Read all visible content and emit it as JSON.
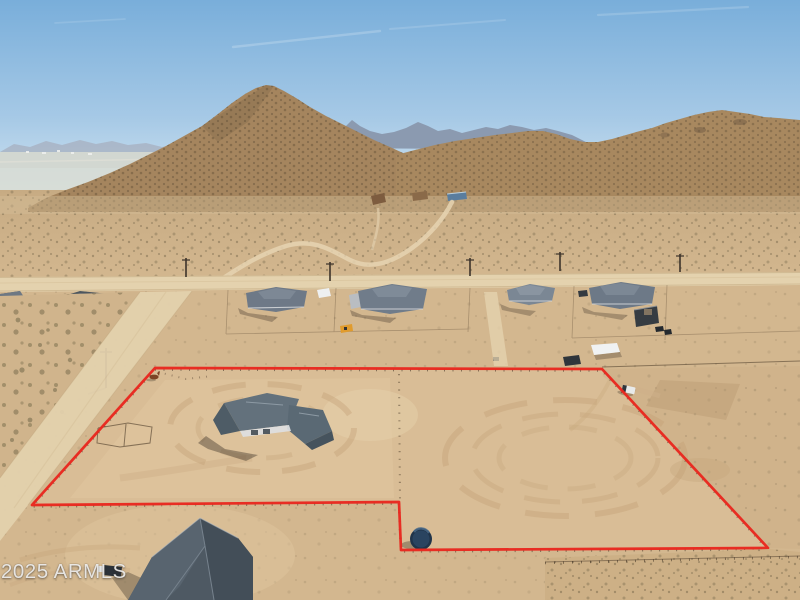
{
  "watermark": {
    "text": "2025 ARMLS"
  },
  "colors": {
    "sky-top": "#79aeda",
    "sky-mid": "#a6c9e6",
    "sky-horizon": "#dcebf3",
    "haze-plain": "#d8dcd2",
    "far-mountain": "#a8b2c2",
    "blue-mountain": "#8b9ab0",
    "mountain": "#a5855e",
    "mountain-right": "#a8885f",
    "desert-mid": "#cbae86",
    "desert-front": "#d3b78f",
    "property-dirt": "#d9bd96",
    "graded-dirt": "#c2a176",
    "light-dirt": "#e6d2ac",
    "road": "#e4d2ae",
    "boundary-red": "#e8281f",
    "roof-dark": "#4d565e",
    "roof-mid": "#6e7987",
    "roof-light": "#7b8794",
    "pool-blue": "#2ea6d4",
    "tank-navy": "#20344a",
    "horse-brown": "#7c4425",
    "machine-yellow": "#e09b2d"
  }
}
